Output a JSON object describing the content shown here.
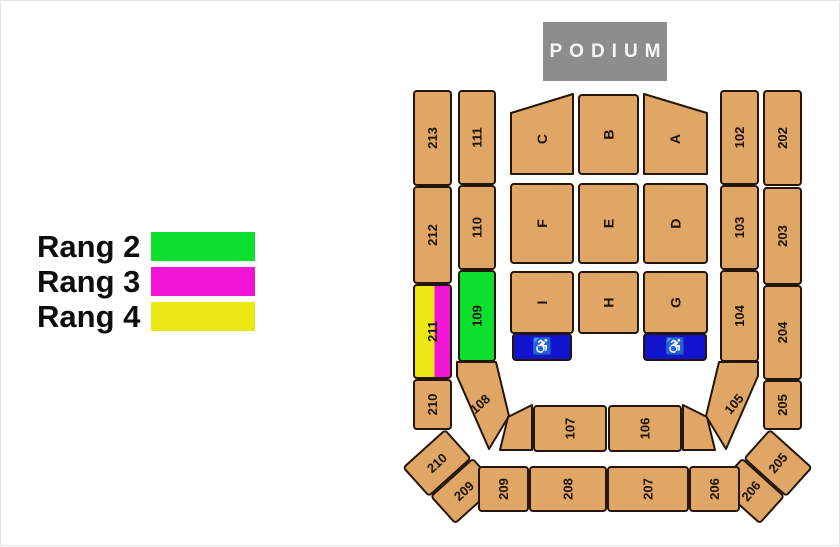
{
  "colors": {
    "tan": "#dfa666",
    "outline": "#24160a",
    "green": "#0cdf2e",
    "magenta": "#f215d6",
    "yellow": "#eae712",
    "blue": "#1213ce",
    "podium_gray": "#8d8d8d",
    "label_dark": "#1c1208",
    "white": "#ffffff"
  },
  "podium": {
    "label": "PODIUM"
  },
  "legend": {
    "items": [
      {
        "label": "Rang 2",
        "color": "#0cdf2e"
      },
      {
        "label": "Rang 3",
        "color": "#f215d6"
      },
      {
        "label": "Rang 4",
        "color": "#eae712"
      }
    ]
  },
  "icons": {
    "wheelchair": "♿"
  },
  "map": {
    "blocks": [
      {
        "id": "213",
        "label": "213",
        "x": 413,
        "y": 90,
        "w": 37,
        "h": 94,
        "labelRot": -90
      },
      {
        "id": "212",
        "label": "212",
        "x": 413,
        "y": 186,
        "w": 37,
        "h": 96,
        "labelRot": -90
      },
      {
        "id": "211",
        "label": "211",
        "x": 413,
        "y": 284,
        "w": 37,
        "h": 93,
        "fill": "split",
        "labelRot": -90
      },
      {
        "id": "210",
        "label": "210",
        "x": 413,
        "y": 379,
        "w": 37,
        "h": 49,
        "labelRot": -90
      },
      {
        "id": "210-corner",
        "label": "210",
        "x": 408,
        "y": 443,
        "w": 56,
        "h": 38,
        "rot": -42,
        "cx": 436,
        "cy": 462,
        "labelRot": -42
      },
      {
        "id": "209-corner",
        "label": "209",
        "x": 435,
        "y": 472,
        "w": 56,
        "h": 36,
        "rot": -42,
        "cx": 463,
        "cy": 490,
        "labelRot": -42
      },
      {
        "id": "111",
        "label": "111",
        "x": 458,
        "y": 90,
        "w": 36,
        "h": 93,
        "labelRot": -90
      },
      {
        "id": "110",
        "label": "110",
        "x": 458,
        "y": 185,
        "w": 36,
        "h": 83,
        "labelRot": -90
      },
      {
        "id": "109",
        "label": "109",
        "x": 458,
        "y": 270,
        "w": 36,
        "h": 90,
        "fill": "green",
        "labelRot": -90
      },
      {
        "id": "108",
        "label": "108",
        "points": "456,361 495,361 508,415 488,448 456,375",
        "cx": 479,
        "cy": 403,
        "labelRot": -42
      },
      {
        "id": "gap-left",
        "points": "507,416 531,404 531,449 499,449"
      },
      {
        "id": "107",
        "label": "107",
        "x": 533,
        "y": 405,
        "w": 72,
        "h": 45,
        "labelRot": -90
      },
      {
        "id": "106",
        "label": "106",
        "x": 608,
        "y": 405,
        "w": 72,
        "h": 45,
        "labelRot": -90
      },
      {
        "id": "gap-right",
        "points": "682,404 706,416 714,449 682,449"
      },
      {
        "id": "105",
        "label": "105",
        "points": "718,361 757,361 757,375 725,448 705,415",
        "cx": 733,
        "cy": 403,
        "labelRot": -50
      },
      {
        "id": "102",
        "label": "102",
        "x": 720,
        "y": 90,
        "w": 37,
        "h": 93,
        "labelRot": -90
      },
      {
        "id": "103",
        "label": "103",
        "x": 720,
        "y": 185,
        "w": 37,
        "h": 83,
        "labelRot": -90
      },
      {
        "id": "104",
        "label": "104",
        "x": 720,
        "y": 270,
        "w": 37,
        "h": 90,
        "labelRot": -90
      },
      {
        "id": "202",
        "label": "202",
        "x": 763,
        "y": 90,
        "w": 37,
        "h": 94,
        "labelRot": -90
      },
      {
        "id": "203",
        "label": "203",
        "x": 763,
        "y": 187,
        "w": 37,
        "h": 96,
        "labelRot": -90
      },
      {
        "id": "204",
        "label": "204",
        "x": 763,
        "y": 285,
        "w": 37,
        "h": 93,
        "labelRot": -90
      },
      {
        "id": "205",
        "label": "205",
        "x": 763,
        "y": 380,
        "w": 37,
        "h": 48,
        "labelRot": -90
      },
      {
        "id": "205-corner",
        "label": "205",
        "x": 749,
        "y": 443,
        "w": 56,
        "h": 38,
        "rot": 42,
        "cx": 777,
        "cy": 462,
        "labelRot": -50
      },
      {
        "id": "206-corner",
        "label": "206",
        "x": 722,
        "y": 472,
        "w": 56,
        "h": 36,
        "rot": 42,
        "cx": 750,
        "cy": 490,
        "labelRot": -50
      },
      {
        "id": "209",
        "label": "209",
        "x": 478,
        "y": 466,
        "w": 49,
        "h": 44,
        "labelRot": -90
      },
      {
        "id": "208",
        "label": "208",
        "x": 529,
        "y": 466,
        "w": 76,
        "h": 44,
        "labelRot": -90
      },
      {
        "id": "207",
        "label": "207",
        "x": 607,
        "y": 466,
        "w": 80,
        "h": 44,
        "labelRot": -90
      },
      {
        "id": "206",
        "label": "206",
        "x": 689,
        "y": 466,
        "w": 49,
        "h": 44,
        "labelRot": -90
      },
      {
        "id": "C",
        "label": "C",
        "points": "510,112 572,93 572,173 510,173",
        "cx": 541,
        "cy": 138,
        "labelRot": -90,
        "fs": 14
      },
      {
        "id": "B",
        "label": "B",
        "x": 578,
        "y": 94,
        "w": 59,
        "h": 79,
        "labelRot": -90,
        "fs": 14
      },
      {
        "id": "A",
        "label": "A",
        "points": "643,93 706,112 706,173 643,173",
        "cx": 674,
        "cy": 138,
        "labelRot": -90,
        "fs": 14
      },
      {
        "id": "F",
        "label": "F",
        "x": 510,
        "y": 183,
        "w": 62,
        "h": 79,
        "labelRot": -90,
        "fs": 14
      },
      {
        "id": "E",
        "label": "E",
        "x": 578,
        "y": 183,
        "w": 59,
        "h": 79,
        "labelRot": -90,
        "fs": 14
      },
      {
        "id": "D",
        "label": "D",
        "x": 643,
        "y": 183,
        "w": 63,
        "h": 79,
        "labelRot": -90,
        "fs": 14
      },
      {
        "id": "I",
        "label": "I",
        "x": 510,
        "y": 271,
        "w": 62,
        "h": 61,
        "labelRot": -90,
        "fs": 14
      },
      {
        "id": "H",
        "label": "H",
        "x": 578,
        "y": 271,
        "w": 59,
        "h": 61,
        "labelRot": -90,
        "fs": 14
      },
      {
        "id": "G",
        "label": "G",
        "x": 643,
        "y": 271,
        "w": 63,
        "h": 61,
        "labelRot": -90,
        "fs": 14
      },
      {
        "id": "wheelchair-left",
        "icon": "wheelchair",
        "x": 512,
        "y": 333,
        "w": 58,
        "h": 26,
        "fill": "blue"
      },
      {
        "id": "wheelchair-right",
        "icon": "wheelchair",
        "x": 643,
        "y": 333,
        "w": 62,
        "h": 26,
        "fill": "blue"
      }
    ]
  }
}
